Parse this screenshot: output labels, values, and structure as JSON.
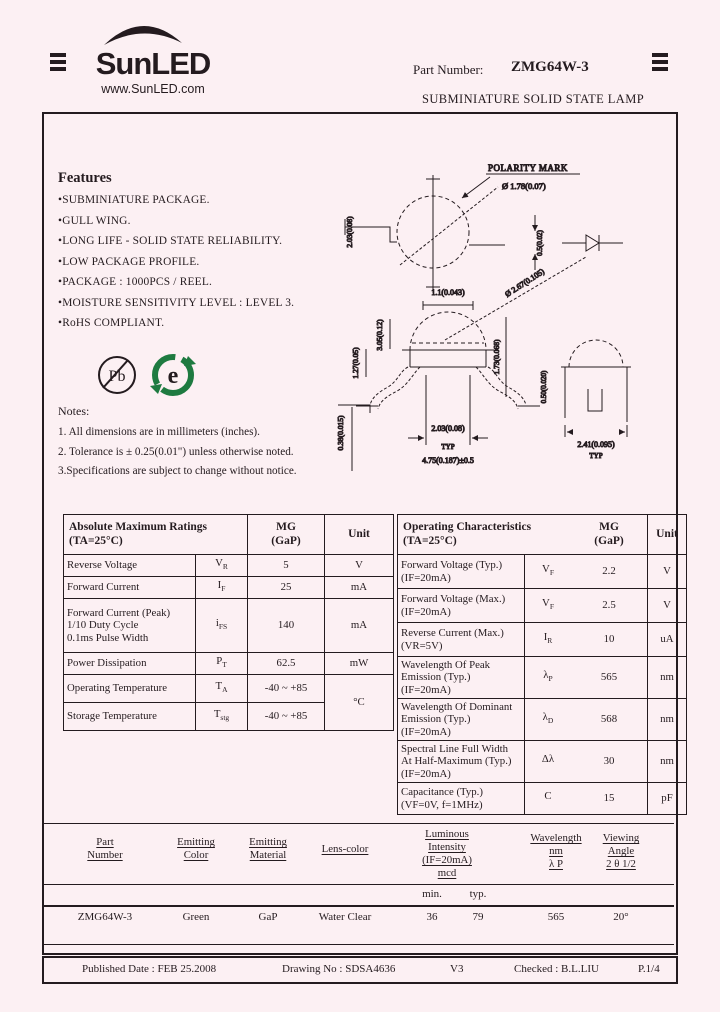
{
  "colors": {
    "bg": "#fcf0f3",
    "ink": "#241b1f",
    "rohs_green": "#1e7a40"
  },
  "header": {
    "brand": "SunLED",
    "site": "www.SunLED.com",
    "part_number_label": "Part Number:",
    "part_number": "ZMG64W-3",
    "subtitle": "SUBMINIATURE SOLID STATE LAMP"
  },
  "features": {
    "title": "Features",
    "items": [
      "•SUBMINIATURE PACKAGE.",
      "•GULL WING.",
      "•LONG LIFE - SOLID STATE RELIABILITY.",
      "•LOW PACKAGE PROFILE.",
      "•PACKAGE : 1000PCS / REEL.",
      "•MOISTURE SENSITIVITY LEVEL : LEVEL 3.",
      "•RoHS COMPLIANT."
    ]
  },
  "icons": {
    "pb_free": "Pb",
    "rohs_e": "e"
  },
  "notes": {
    "title": "Notes:",
    "lines": [
      "1. All dimensions are in millimeters (inches).",
      "2. Tolerance is ± 0.25(0.01\") unless otherwise noted.",
      "3.Specifications are subject to change without notice."
    ]
  },
  "drawing": {
    "polarity_mark": "POLARITY MARK",
    "top_circle_dia": "Ø 1.78(0.07)",
    "top_left_dim": "2.03(0.08)",
    "top_right_dim": "0.5(0.02)",
    "front_top_dim": "1.1(0.043)",
    "dome_dia": "Ø 2.67(0.105)",
    "front_left_h": "3.05(0.12)",
    "front_left_h2": "1.27(0.05)",
    "front_left_h3": "0.38(0.015)",
    "front_right_h": "1.73(0.068)",
    "mid_col": "0.50(0.020)",
    "bottom_dim1": "2.03(0.08)",
    "bottom_typ": "TYP",
    "bottom_dim2": "4.75(0.187)±0.5",
    "side_w": "2.41(0.095)",
    "side_typ": "TYP"
  },
  "abs_table": {
    "title": "Absolute Maximum Ratings\n(TA=25°C)",
    "col_value": "MG\n(GaP)",
    "col_unit": "Unit",
    "rows": [
      {
        "param": "Reverse Voltage",
        "sym": "V",
        "sub": "R",
        "value": "5",
        "unit": "V"
      },
      {
        "param": "Forward Current",
        "sym": "I",
        "sub": "F",
        "value": "25",
        "unit": "mA"
      },
      {
        "param": "Forward Current (Peak)\n1/10 Duty Cycle\n0.1ms Pulse Width",
        "sym": "i",
        "sub": "FS",
        "value": "140",
        "unit": "mA"
      },
      {
        "param": "Power Dissipation",
        "sym": "P",
        "sub": "T",
        "value": "62.5",
        "unit": "mW"
      },
      {
        "param": "Operating Temperature",
        "sym": "T",
        "sub": "A",
        "value": "-40 ~ +85",
        "unit": "°C"
      },
      {
        "param": "Storage Temperature",
        "sym": "T",
        "sub": "stg",
        "value": "-40 ~ +85",
        "unit": ""
      }
    ]
  },
  "op_table": {
    "title": "Operating Characteristics\n(TA=25°C)",
    "col_value": "MG\n(GaP)",
    "col_unit": "Unit",
    "rows": [
      {
        "param": "Forward Voltage (Typ.)\n(IF=20mA)",
        "sym": "V",
        "sub": "F",
        "value": "2.2",
        "unit": "V"
      },
      {
        "param": "Forward Voltage (Max.)\n(IF=20mA)",
        "sym": "V",
        "sub": "F",
        "value": "2.5",
        "unit": "V"
      },
      {
        "param": "Reverse Current (Max.)\n(VR=5V)",
        "sym": "I",
        "sub": "R",
        "value": "10",
        "unit": "uA"
      },
      {
        "param": "Wavelength Of Peak\nEmission (Typ.)\n(IF=20mA)",
        "sym": "λ",
        "sub": "P",
        "value": "565",
        "unit": "nm"
      },
      {
        "param": "Wavelength Of Dominant\nEmission (Typ.)\n(IF=20mA)",
        "sym": "λ",
        "sub": "D",
        "value": "568",
        "unit": "nm"
      },
      {
        "param": "Spectral Line Full Width\nAt Half-Maximum (Typ.)\n(IF=20mA)",
        "sym": "Δλ",
        "sub": "",
        "value": "30",
        "unit": "nm"
      },
      {
        "param": "Capacitance (Typ.)\n(VF=0V, f=1MHz)",
        "sym": "C",
        "sub": "",
        "value": "15",
        "unit": "pF"
      }
    ]
  },
  "selection_table": {
    "headers": {
      "part": "Part\nNumber",
      "color": "Emitting\nColor",
      "material": "Emitting\nMaterial",
      "lens": "Lens-color",
      "intensity": "Luminous\nIntensity\n(IF=20mA)\nmcd",
      "wavelength": "Wavelength\nnm\nλ P",
      "angle": "Viewing\nAngle\n2 θ 1/2"
    },
    "sub_min": "min.",
    "sub_typ": "typ.",
    "row": {
      "part": "ZMG64W-3",
      "color": "Green",
      "material": "GaP",
      "lens": "Water Clear",
      "iv_min": "36",
      "iv_typ": "79",
      "wavelength": "565",
      "angle": "20°"
    }
  },
  "footer": {
    "published": "Published Date :  FEB  25.2008",
    "drawing_no": "Drawing No : SDSA4636",
    "version": "V3",
    "checked": "Checked : B.L.LIU",
    "page": "P.1/4"
  }
}
